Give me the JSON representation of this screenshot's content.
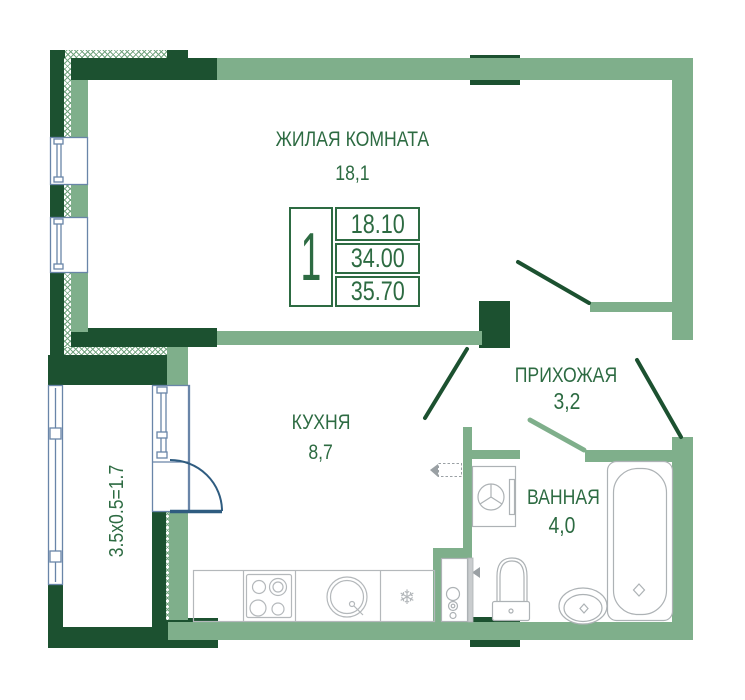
{
  "colors": {
    "wall_dark": "#1c5130",
    "wall_light": "#7faf8b",
    "door_frame_navy": "#2f5c80",
    "window_frame_blue": "#6985a8",
    "text_green": "#2d6b42",
    "fixture_gray": "#b4b8bb"
  },
  "rooms": [
    {
      "name": "ЖИЛАЯ КОМНАТА",
      "area": "18,1"
    },
    {
      "name": "КУХНЯ",
      "area": "8,7"
    },
    {
      "name": "ПРИХОЖАЯ",
      "area": "3,2"
    },
    {
      "name": "ВАННАЯ",
      "area": "4,0"
    }
  ],
  "balcony": {
    "dimensions_formula": "3.5x0.5=1.7"
  },
  "stamp": {
    "rooms_count": "1",
    "living_area": "18.10",
    "total_area": "34.00",
    "total_area_with_balcony": "35.70"
  },
  "icons": {
    "fridge_snowflake": "❄"
  }
}
